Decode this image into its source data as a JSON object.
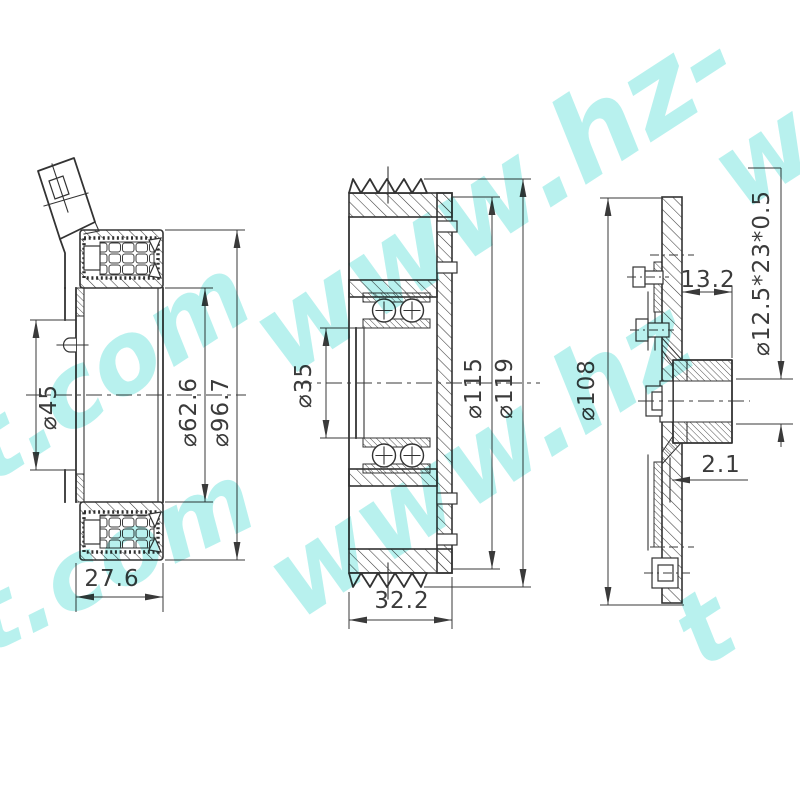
{
  "drawing": {
    "background": "#ffffff",
    "line_color": "#333333",
    "watermark_color": "#7ee6e0"
  },
  "views": {
    "coil": {
      "name": "electromagnetic-coil-section-view",
      "dims": {
        "d45": "⌀45",
        "d62": "⌀62.6",
        "d96": "⌀96.7",
        "w27": "27.6"
      }
    },
    "pulley": {
      "name": "pulley-bearing-section-view",
      "dims": {
        "d35": "⌀35",
        "d115": "⌀115",
        "d119": "⌀119",
        "w32": "32.2"
      }
    },
    "hub": {
      "name": "clutch-hub-section-view",
      "dims": {
        "w13": "13.2",
        "spec": "⌀12.5*23*0.5",
        "d108": "⌀108",
        "t2": "2.1"
      }
    }
  },
  "watermarks": [
    {
      "text": "t.com"
    },
    {
      "text": "www.hz-"
    },
    {
      "text": "t.com"
    },
    {
      "text": "www.hz"
    },
    {
      "text": "w"
    },
    {
      "text": "t"
    }
  ]
}
